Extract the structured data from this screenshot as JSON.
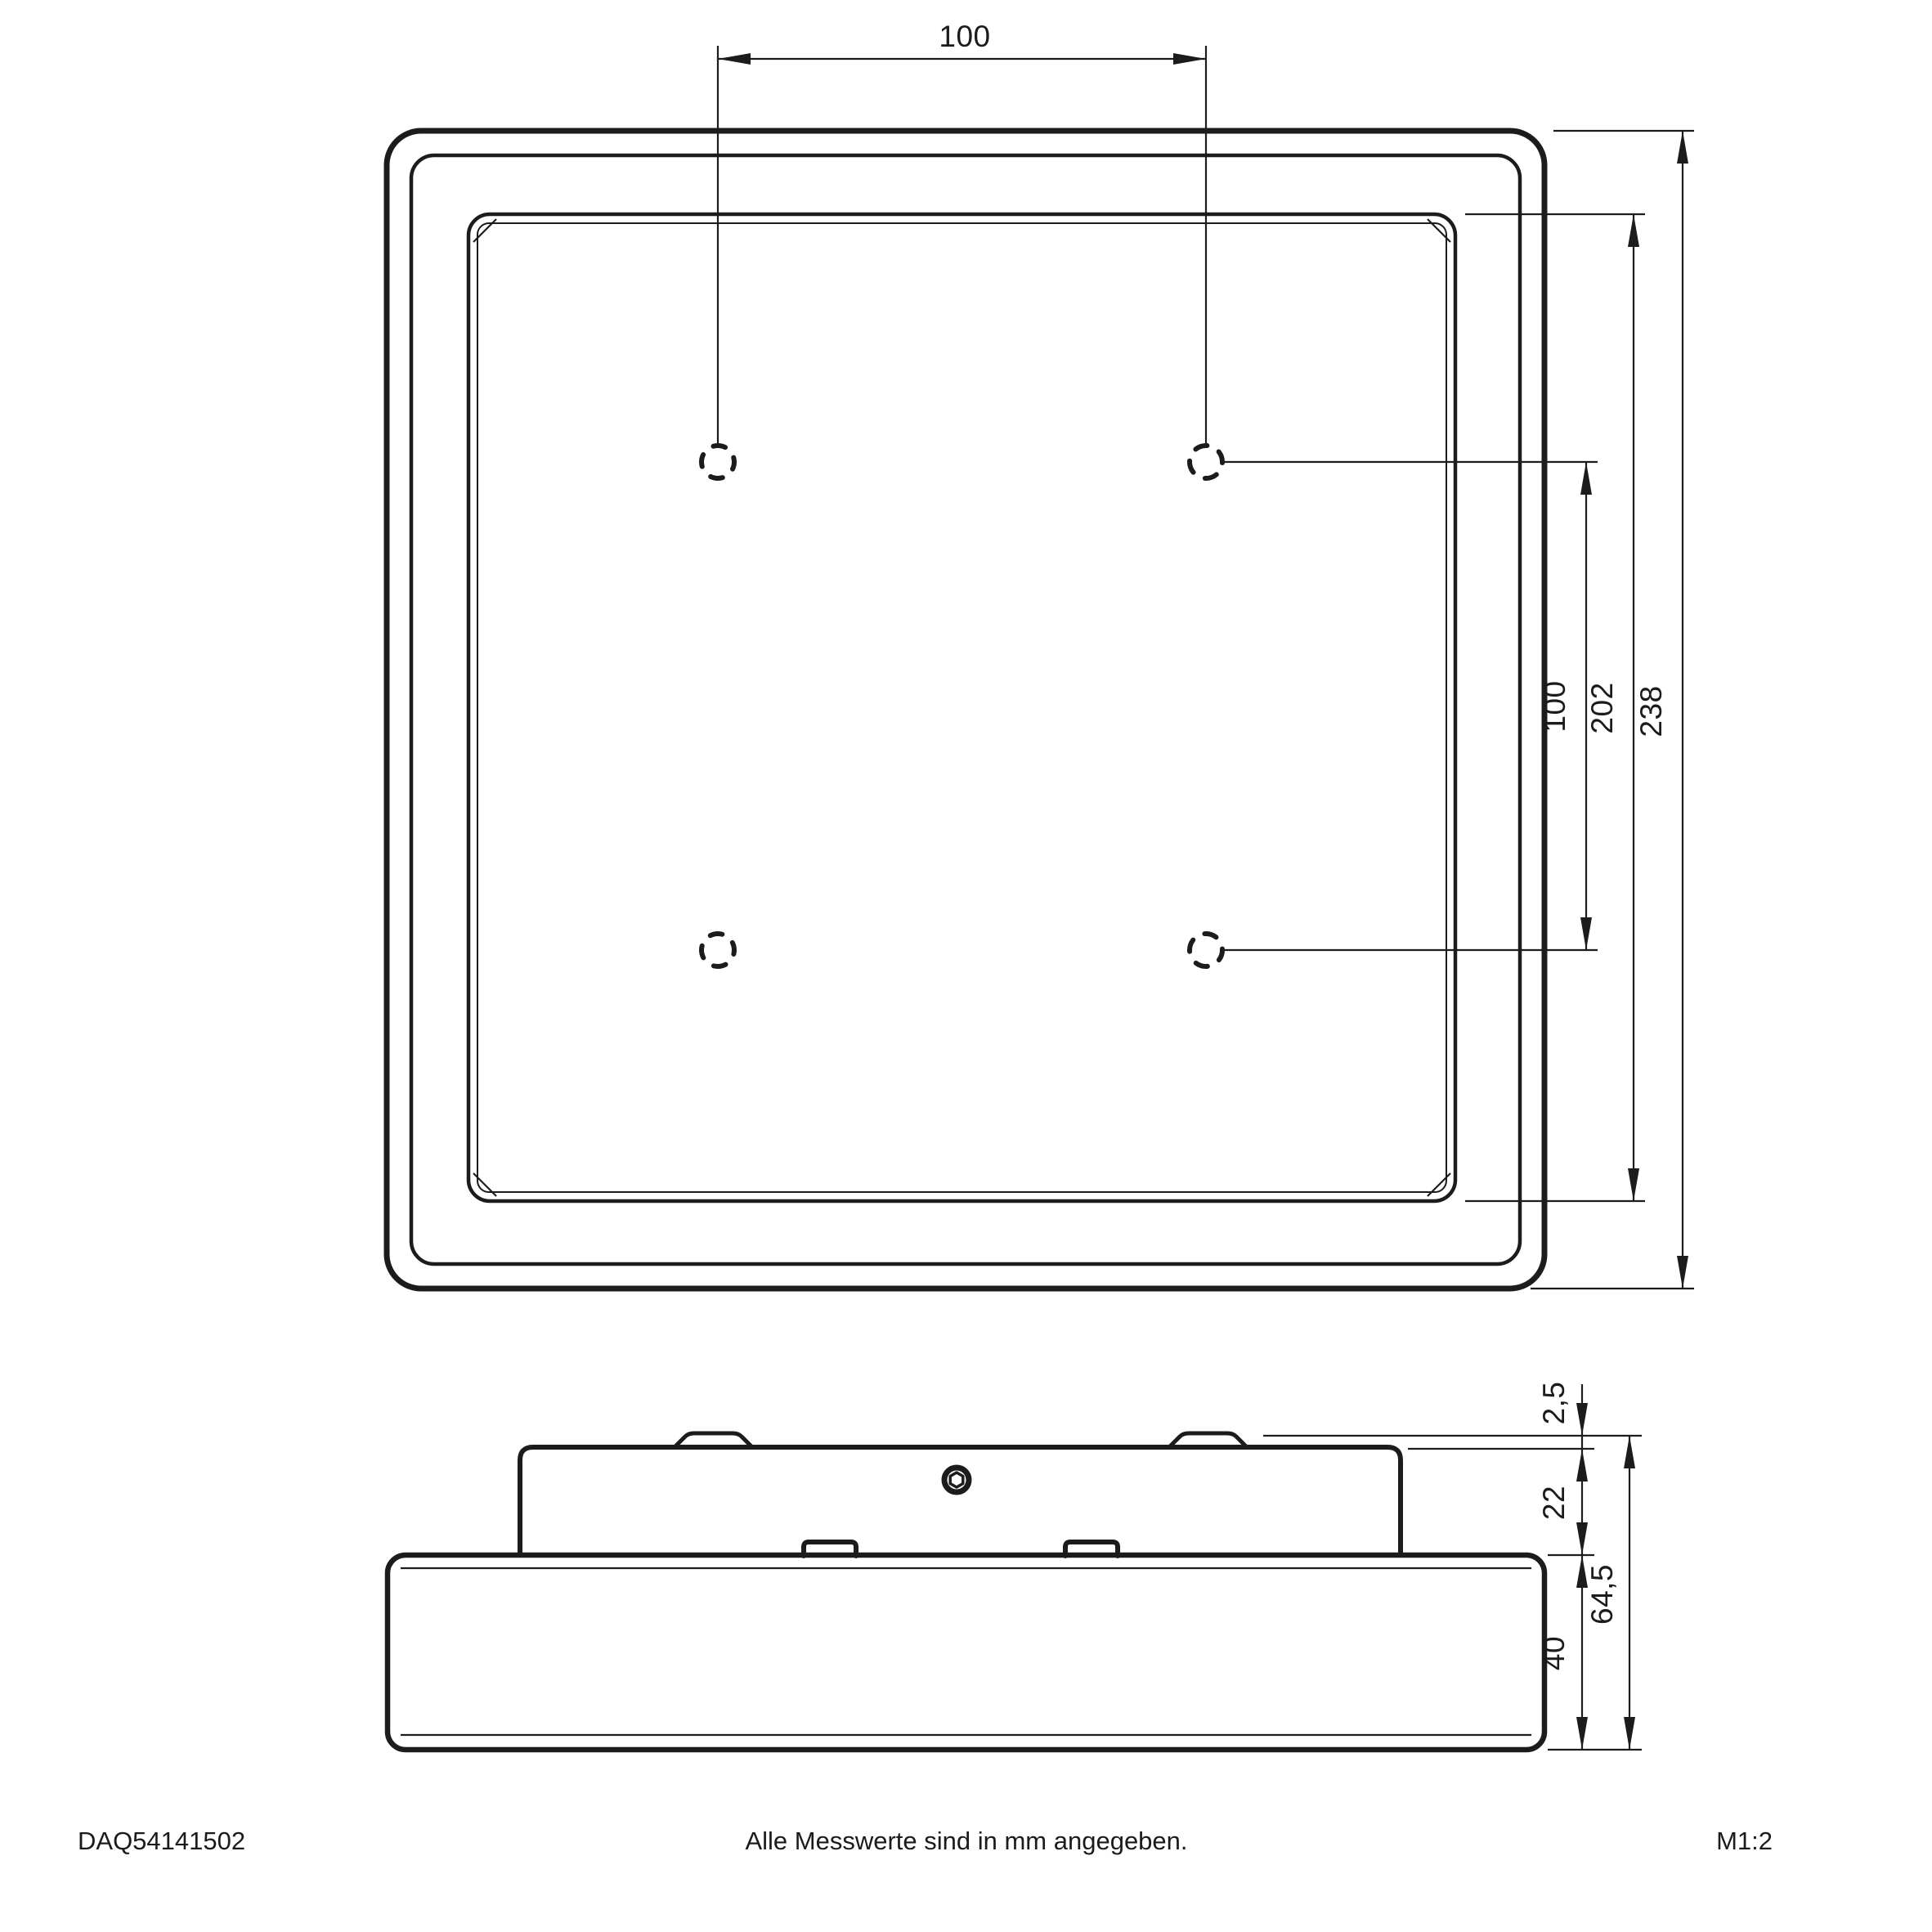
{
  "drawing": {
    "line_color": "#1c1c1c",
    "background": "#ffffff",
    "top_view": {
      "dim_hole_spacing_horizontal": "100",
      "dim_hole_spacing_vertical": "100",
      "dim_inner_frame": "202",
      "dim_outer_frame": "238"
    },
    "side_view": {
      "dim_clip_protrusion": "2,5",
      "dim_recess_height": "22",
      "dim_frame_height": "40",
      "dim_total_height": "64,5"
    },
    "footer": {
      "part_number": "DAQ54141502",
      "note": "Alle Messwerte sind in mm angegeben.",
      "scale": "M1:2"
    }
  }
}
